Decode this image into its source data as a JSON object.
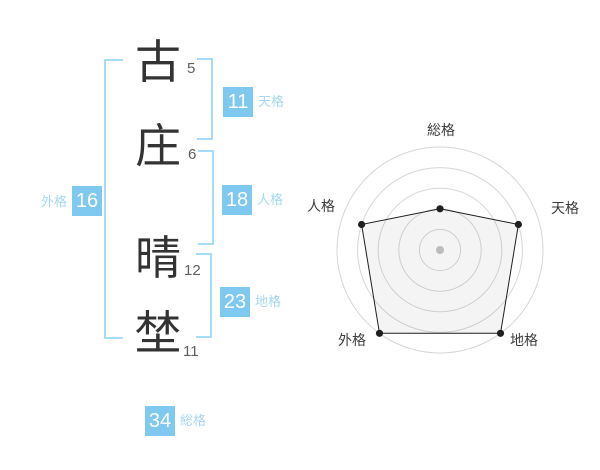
{
  "name": {
    "chars": [
      {
        "char": "古",
        "strokes": "5"
      },
      {
        "char": "庄",
        "strokes": "6"
      },
      {
        "char": "晴",
        "strokes": "12"
      },
      {
        "char": "埜",
        "strokes": "11"
      }
    ]
  },
  "scores": {
    "tenkaku": {
      "label": "天格",
      "value": "11"
    },
    "jinkaku": {
      "label": "人格",
      "value": "18"
    },
    "chikaku": {
      "label": "地格",
      "value": "23"
    },
    "gaikaku": {
      "label": "外格",
      "value": "16"
    },
    "soukaku": {
      "label": "総格",
      "value": "34"
    }
  },
  "chart_data": {
    "type": "radar",
    "axes": [
      {
        "label": "総格",
        "value": 2
      },
      {
        "label": "天格",
        "value": 4
      },
      {
        "label": "地格",
        "value": 5
      },
      {
        "label": "外格",
        "value": 5
      },
      {
        "label": "人格",
        "value": 4
      }
    ],
    "max": 5,
    "rings": 5,
    "start_angle_deg": -90,
    "direction": "clockwise",
    "grid": "circular",
    "legend_position": "none"
  },
  "colors": {
    "accent_box": "#7fc8ef",
    "accent_label": "#a5d8f3",
    "bracket": "#a5dcf8",
    "char_text": "#333333",
    "stroke_text": "#5f5f5f",
    "ring": "#d6d6d6",
    "center_dot": "#c3c3c3",
    "polygon_stroke": "#1f1f1f",
    "polygon_fill": "rgba(120,120,120,0.08)",
    "axis_label": "#3d3d3d"
  }
}
